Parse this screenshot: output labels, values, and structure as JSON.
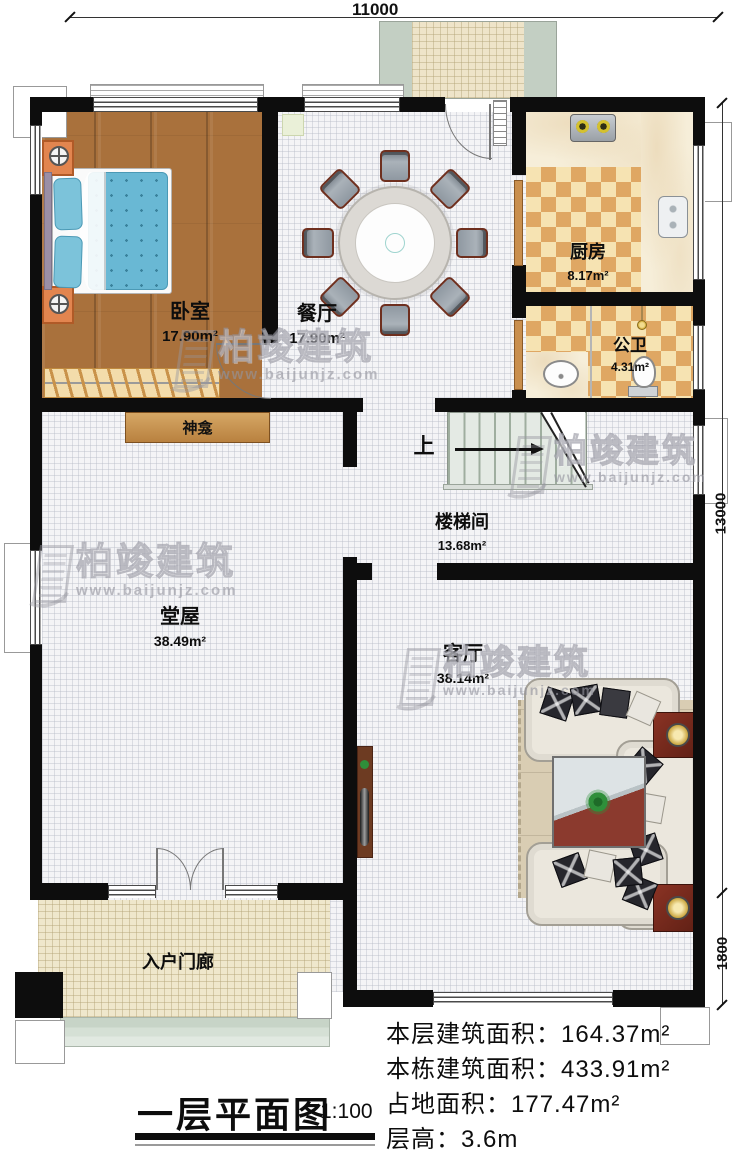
{
  "dimensions": {
    "top": "11000",
    "right_upper": "13000",
    "right_lower": "1800"
  },
  "rooms": {
    "bedroom": {
      "name": "卧室",
      "area": "17.90m²"
    },
    "dining": {
      "name": "餐厅",
      "area": "17.90m²"
    },
    "kitchen": {
      "name": "厨房",
      "area": "8.17m²"
    },
    "bathroom": {
      "name": "公卫",
      "area": "4.31m²"
    },
    "stairwell": {
      "name": "楼梯间",
      "area": "13.68m²"
    },
    "hall": {
      "name": "堂屋",
      "area": "38.49m²"
    },
    "living": {
      "name": "客厅",
      "area": "38.14m²"
    },
    "porch": {
      "name": "入户门廊"
    }
  },
  "annotations": {
    "shrine": "神龛",
    "stairs_up": "上"
  },
  "title_block": {
    "title": "一层平面图",
    "scale": "1:100"
  },
  "stats": {
    "line1": {
      "label": "本层建筑面积：",
      "value": "164.37m²"
    },
    "line2": {
      "label": "本栋建筑面积：",
      "value": "433.91m²"
    },
    "line3": {
      "label": "占地面积：",
      "value": "177.47m²"
    },
    "line4": {
      "label": "层高：",
      "value": "3.6m"
    }
  },
  "watermark": {
    "brand": "柏竣建筑",
    "url": "www.baijunjz.com"
  },
  "colors": {
    "wall": "#0d0d0d",
    "wood_floor": "#a9713c",
    "checker_dark": "#dfa763",
    "checker_light": "#f6e3b2",
    "porch_floor": "#efe7cc",
    "accent_wood": "#c8945a"
  }
}
